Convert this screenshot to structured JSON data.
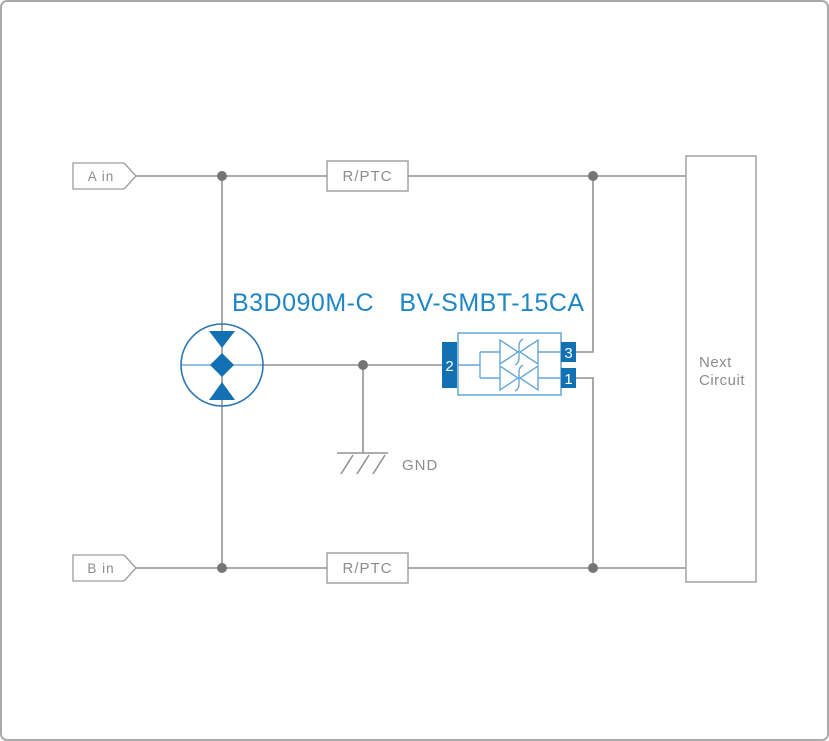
{
  "diagram": {
    "type": "protection-circuit-schematic",
    "terminals": {
      "input_a": "A in",
      "input_b": "B in"
    },
    "components": {
      "rptc_a": "R/PTC",
      "rptc_b": "R/PTC",
      "gdt_part_number": "B3D090M-C",
      "tvs_part_number": "BV-SMBT-15CA",
      "next_circuit_line1": "Next",
      "next_circuit_line2": "Circuit",
      "ground_label": "GND"
    },
    "tvs_pins": {
      "left": "2",
      "top_right": "3",
      "bottom_right": "1"
    },
    "colors": {
      "frame_border": "#aaaaaa",
      "wire_gray": "#929292",
      "box_border": "#9c9c9c",
      "text_gray": "#8c8c8c",
      "junction_dot": "#757575",
      "blue_fill": "#1171b3",
      "blue_label": "#1f86c5",
      "blue_body_outline": "#66a7d7",
      "gdt_outline": "#2d76b4"
    }
  }
}
